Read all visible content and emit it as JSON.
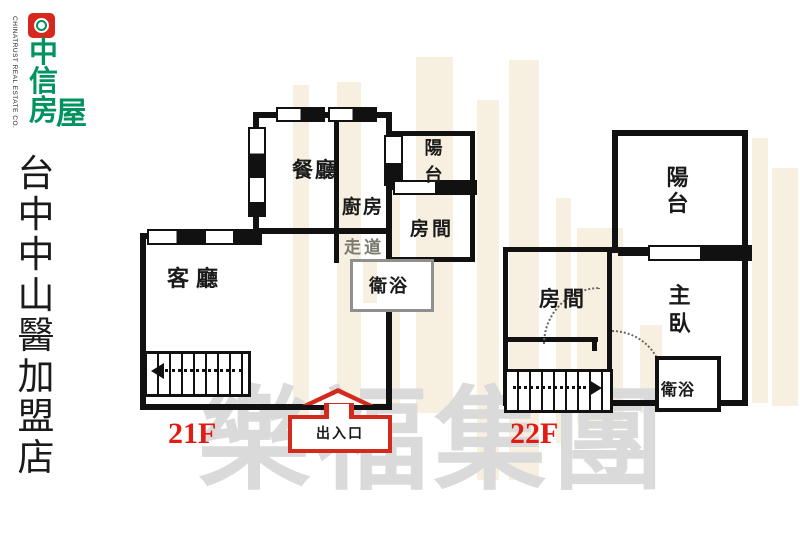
{
  "branding": {
    "logo_chars": {
      "c1": "中",
      "c2": "信",
      "c3": "房",
      "c4": "屋"
    },
    "logo_subtitle": "CHINATRUST REAL ESTATE CO.",
    "store_name": "台中中山醫加盟店"
  },
  "watermark": {
    "company": "樂福集團"
  },
  "plan": {
    "u21": {
      "floor": "21F",
      "dining": "餐廳",
      "kitchen": "廚房",
      "corridor": "走道",
      "bath": "衛浴",
      "living": "客廳",
      "room": "房間",
      "balcony": "陽台",
      "entrance": "出入口"
    },
    "u22": {
      "floor": "22F",
      "balcony": "陽台",
      "room": "房間",
      "master": "主臥",
      "bath": "衛浴"
    }
  },
  "colors": {
    "brand_green": "#00935f",
    "brand_red": "#d6281e",
    "wall_black": "#111111",
    "entrance_red": "#d42a1e",
    "floor_label_red": "#e31b12",
    "watermark_gray": "#dadada",
    "watermark_tan": "#f1e3c9",
    "corridor_text_gray": "#7a7a70",
    "bath_border_gray": "#8f8f8f"
  }
}
